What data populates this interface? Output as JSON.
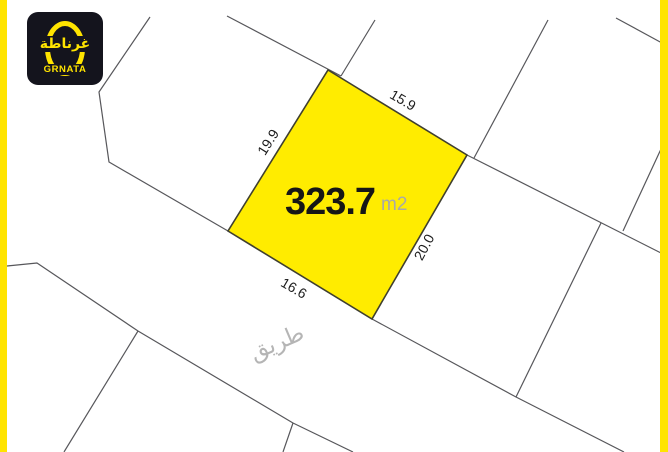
{
  "brand": {
    "logo_arabic": "غرناطة",
    "logo_latin": "GRNATA",
    "logo_bg": "#14141d",
    "accent_yellow": "#ffe400"
  },
  "plot": {
    "fill": "#ffec00",
    "area_value": "323.7",
    "area_unit": "m2",
    "dimensions": {
      "top": "15.9",
      "left": "19.9",
      "right": "20.0",
      "bottom": "16.6"
    }
  },
  "road": {
    "label": "طريق"
  }
}
